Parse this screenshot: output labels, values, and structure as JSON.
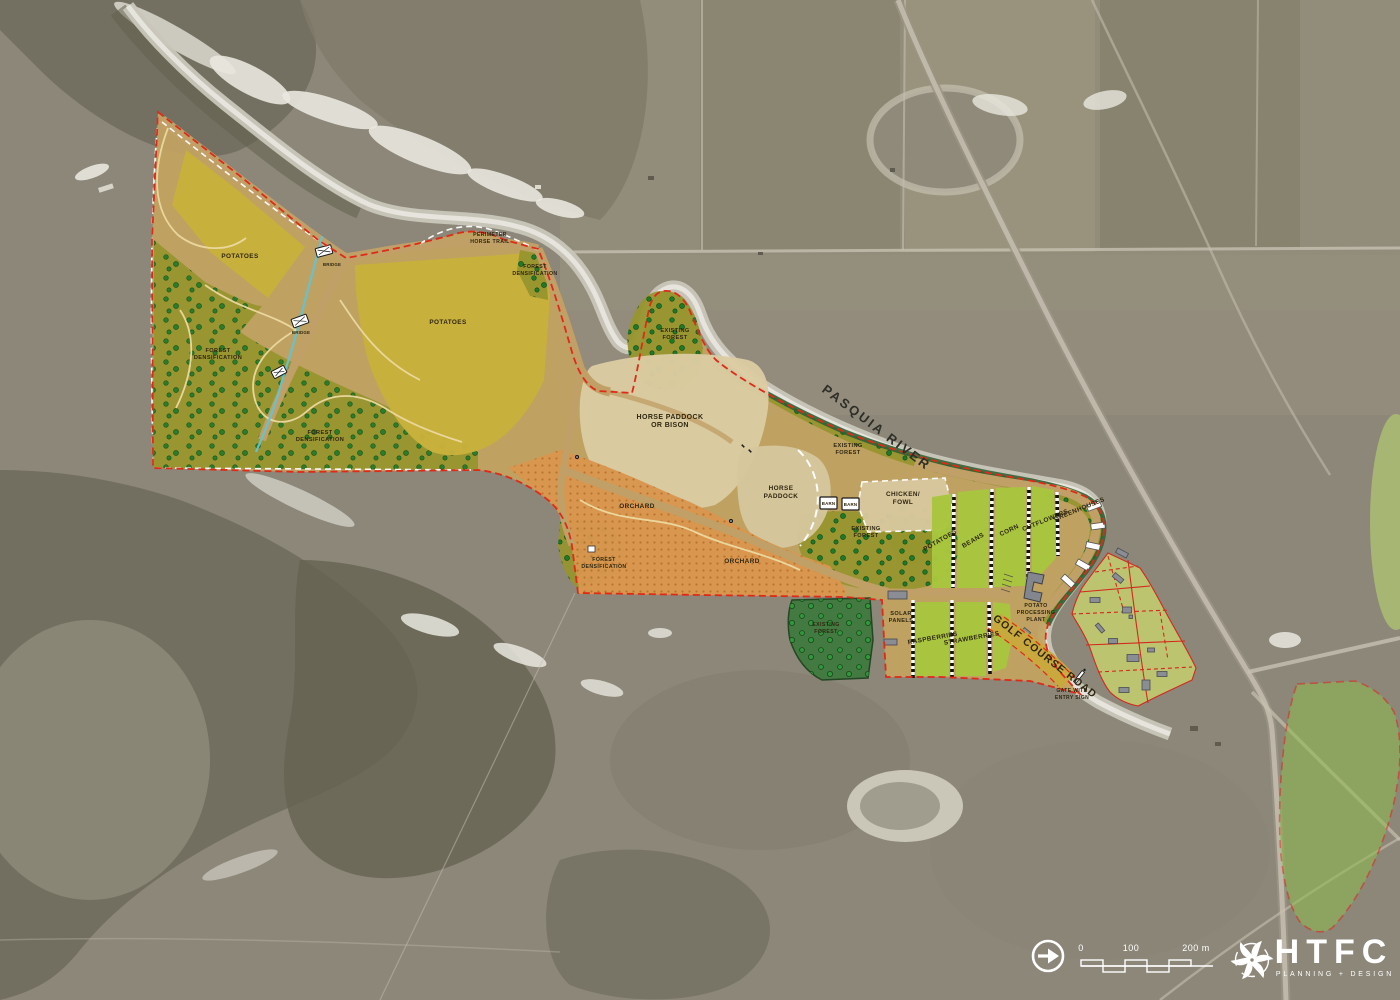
{
  "title": "Farm land-use site plan over aerial photograph",
  "zones": {
    "potatoes": "POTATOES",
    "beans": "BEANS",
    "corn": "CORN",
    "cutflowers": "CUTFLOWERS",
    "greenhouses": "GREENHOUSES",
    "raspberries": "RASPBERRIES",
    "strawberries": "STRAWBERRIES",
    "orchard": "ORCHARD",
    "horse_paddock": {
      "line1": "HORSE",
      "line2": "PADDOCK"
    },
    "horse_paddock_bison": {
      "line1": "HORSE PADDOCK",
      "line2": "OR BISON"
    },
    "chicken_fowl": {
      "line1": "CHICKEN/",
      "line2": "FOWL"
    },
    "existing_forest": {
      "line1": "EXISTING",
      "line2": "FOREST"
    },
    "forest_densification": {
      "line1": "FOREST",
      "line2": "DENSIFICATION"
    },
    "barn": "BARN",
    "solar_panels": {
      "line1": "SOLAR",
      "line2": "PANELS"
    },
    "potato_processing_plant": {
      "line1": "POTATO",
      "line2": "PROCESSING",
      "line3": "PLANT"
    }
  },
  "features": {
    "river_name": "PASQUIA RIVER",
    "road_name": "GOLF COURSE ROAD",
    "gate": {
      "line1": "GATE WITH",
      "line2": "ENTRY SIGN"
    },
    "perimeter_trail": {
      "line1": "PERIMETER",
      "line2": "HORSE TRAIL"
    },
    "bridge": "BRIDGE"
  },
  "scale_bar": {
    "zero": "0",
    "hundred": "100",
    "two_hundred": "200 m"
  },
  "logo": {
    "name": "HTFC",
    "tagline": "PLANNING + DESIGN"
  },
  "colors": {
    "boundary_red": "#e02a18",
    "field_yellow": "#c8b13c",
    "orchard_orange": "#d9964e",
    "crop_green": "#a9c73f",
    "forest_olive": "#97952e",
    "dark_forest_green": "#3f7a40",
    "paddock_beige": "#dbcba2",
    "path_tan": "#c3a261",
    "river_gray": "#d6d4ca",
    "stream_cyan": "#62c3d5",
    "residential_green": "#c6cf6d",
    "logo_white": "#ffffff"
  }
}
